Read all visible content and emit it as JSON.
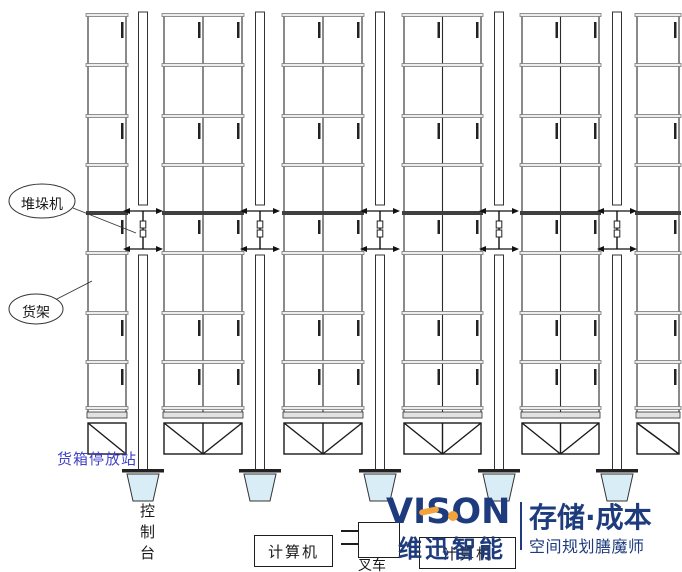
{
  "diagram": {
    "labels": {
      "stacker_crane": "堆垛机",
      "rack": "货架",
      "container_station": "货箱停放站",
      "control_console": "控制台",
      "computer_left": "计算机",
      "computer_right": "计算机",
      "forklift": "叉车"
    },
    "colors": {
      "console_fill": "#d9edf6",
      "station_label_blue": "#4343c9",
      "line_dark": "#2b2b2b"
    }
  },
  "logo": {
    "wordmark_pre": "VIS",
    "wordmark_o": "O",
    "wordmark_n": "N",
    "brand_cn": "维迅智能",
    "tagline_main": "存储·成本",
    "tagline_sub": "空间规划膳魔师",
    "navy": "#1e3c7d",
    "orange": "#f2a33c"
  }
}
